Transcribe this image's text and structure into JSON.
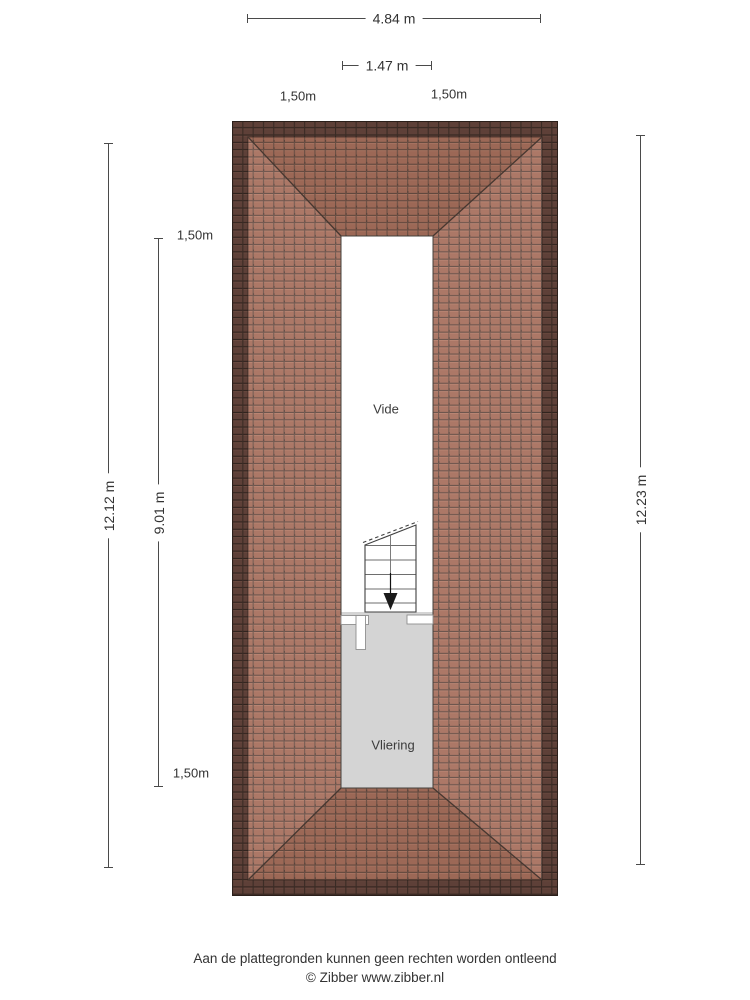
{
  "dimensions": {
    "top_width": "4.84 m",
    "opening_width": "1.47 m",
    "offset_top_left": "1,50m",
    "offset_top_right": "1,50m",
    "left_total": "12.12 m",
    "left_inner": "9.01 m",
    "offset_left_top": "1,50m",
    "offset_left_bottom": "1,50m",
    "right_total": "12.23 m"
  },
  "rooms": {
    "vide": "Vide",
    "vliering": "Vliering"
  },
  "footer": {
    "disclaimer": "Aan de plattegronden kunnen geen rechten worden ontleend",
    "copyright": "© Zibber www.zibber.nl"
  },
  "colors": {
    "roof_tile": "#a8715f",
    "roof_edge_dark": "#5e4038",
    "grout_line": "#644c43",
    "vliering_fill": "#d4d4d4",
    "dimension_line": "#4a4a4a",
    "background": "#ffffff"
  }
}
